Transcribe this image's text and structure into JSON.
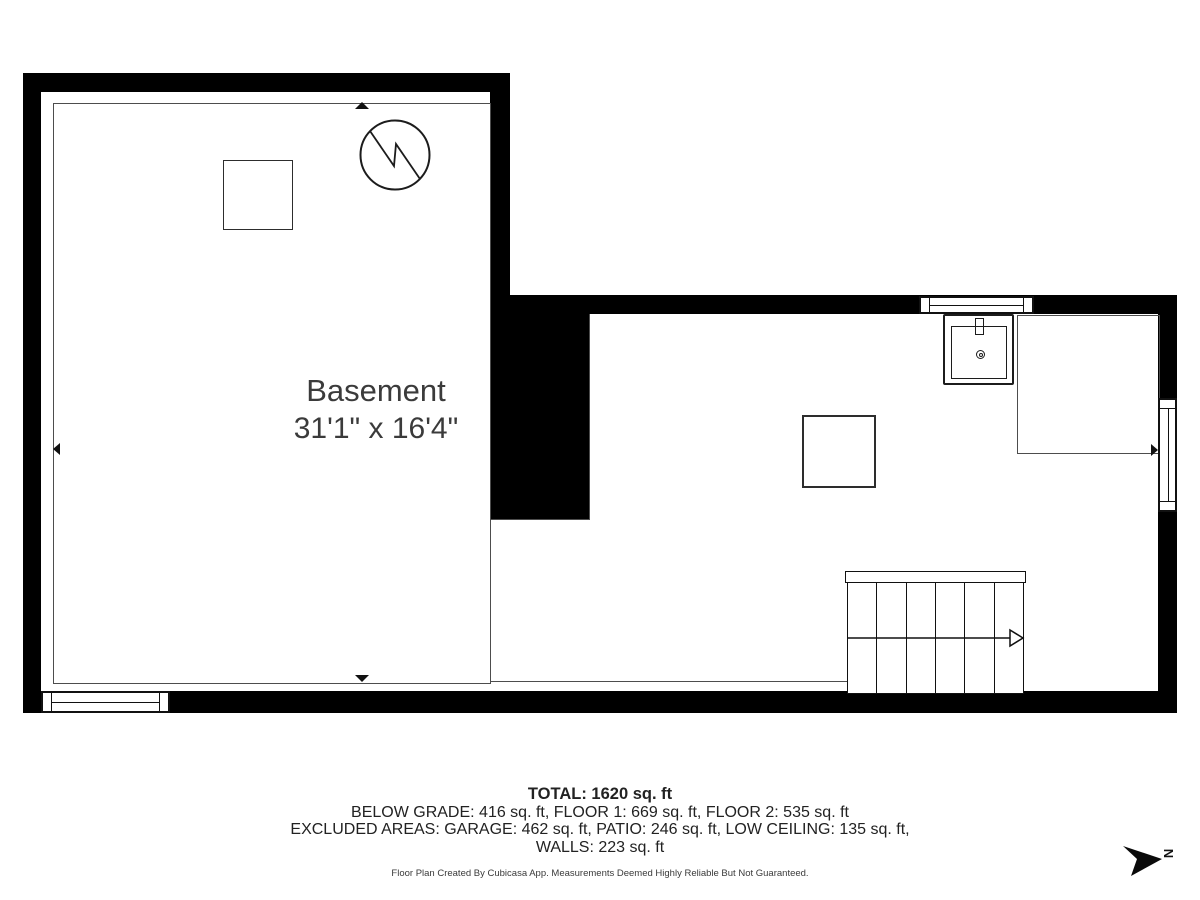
{
  "room": {
    "name": "Basement",
    "dimensions": "31'1\" x 16'4\""
  },
  "summary": {
    "total": "TOTAL: 1620 sq. ft",
    "areas": "BELOW GRADE: 416 sq. ft, FLOOR 1: 669 sq. ft, FLOOR 2: 535 sq. ft",
    "excluded": "EXCLUDED AREAS: GARAGE: 462 sq. ft, PATIO: 246 sq. ft, LOW CEILING: 135 sq. ft,",
    "walls": "WALLS: 223 sq. ft"
  },
  "disclaimer": "Floor Plan Created By Cubicasa App. Measurements Deemed Highly Reliable But Not Guaranteed.",
  "compass": {
    "north_label": "N"
  },
  "icons": {
    "water_heater": "circle-with-zigzag",
    "sink": "basin-with-faucet-and-drain",
    "stairs_direction": "open-arrow-right",
    "north_arrow": "filled-arrowhead-right",
    "dimension_markers": "filled-triangles-at-walls"
  },
  "colors": {
    "wall": "#000000",
    "room_outline": "#4d4d4d",
    "label_text": "#3b3b3b",
    "footer_text": "#222222",
    "background": "#ffffff"
  }
}
